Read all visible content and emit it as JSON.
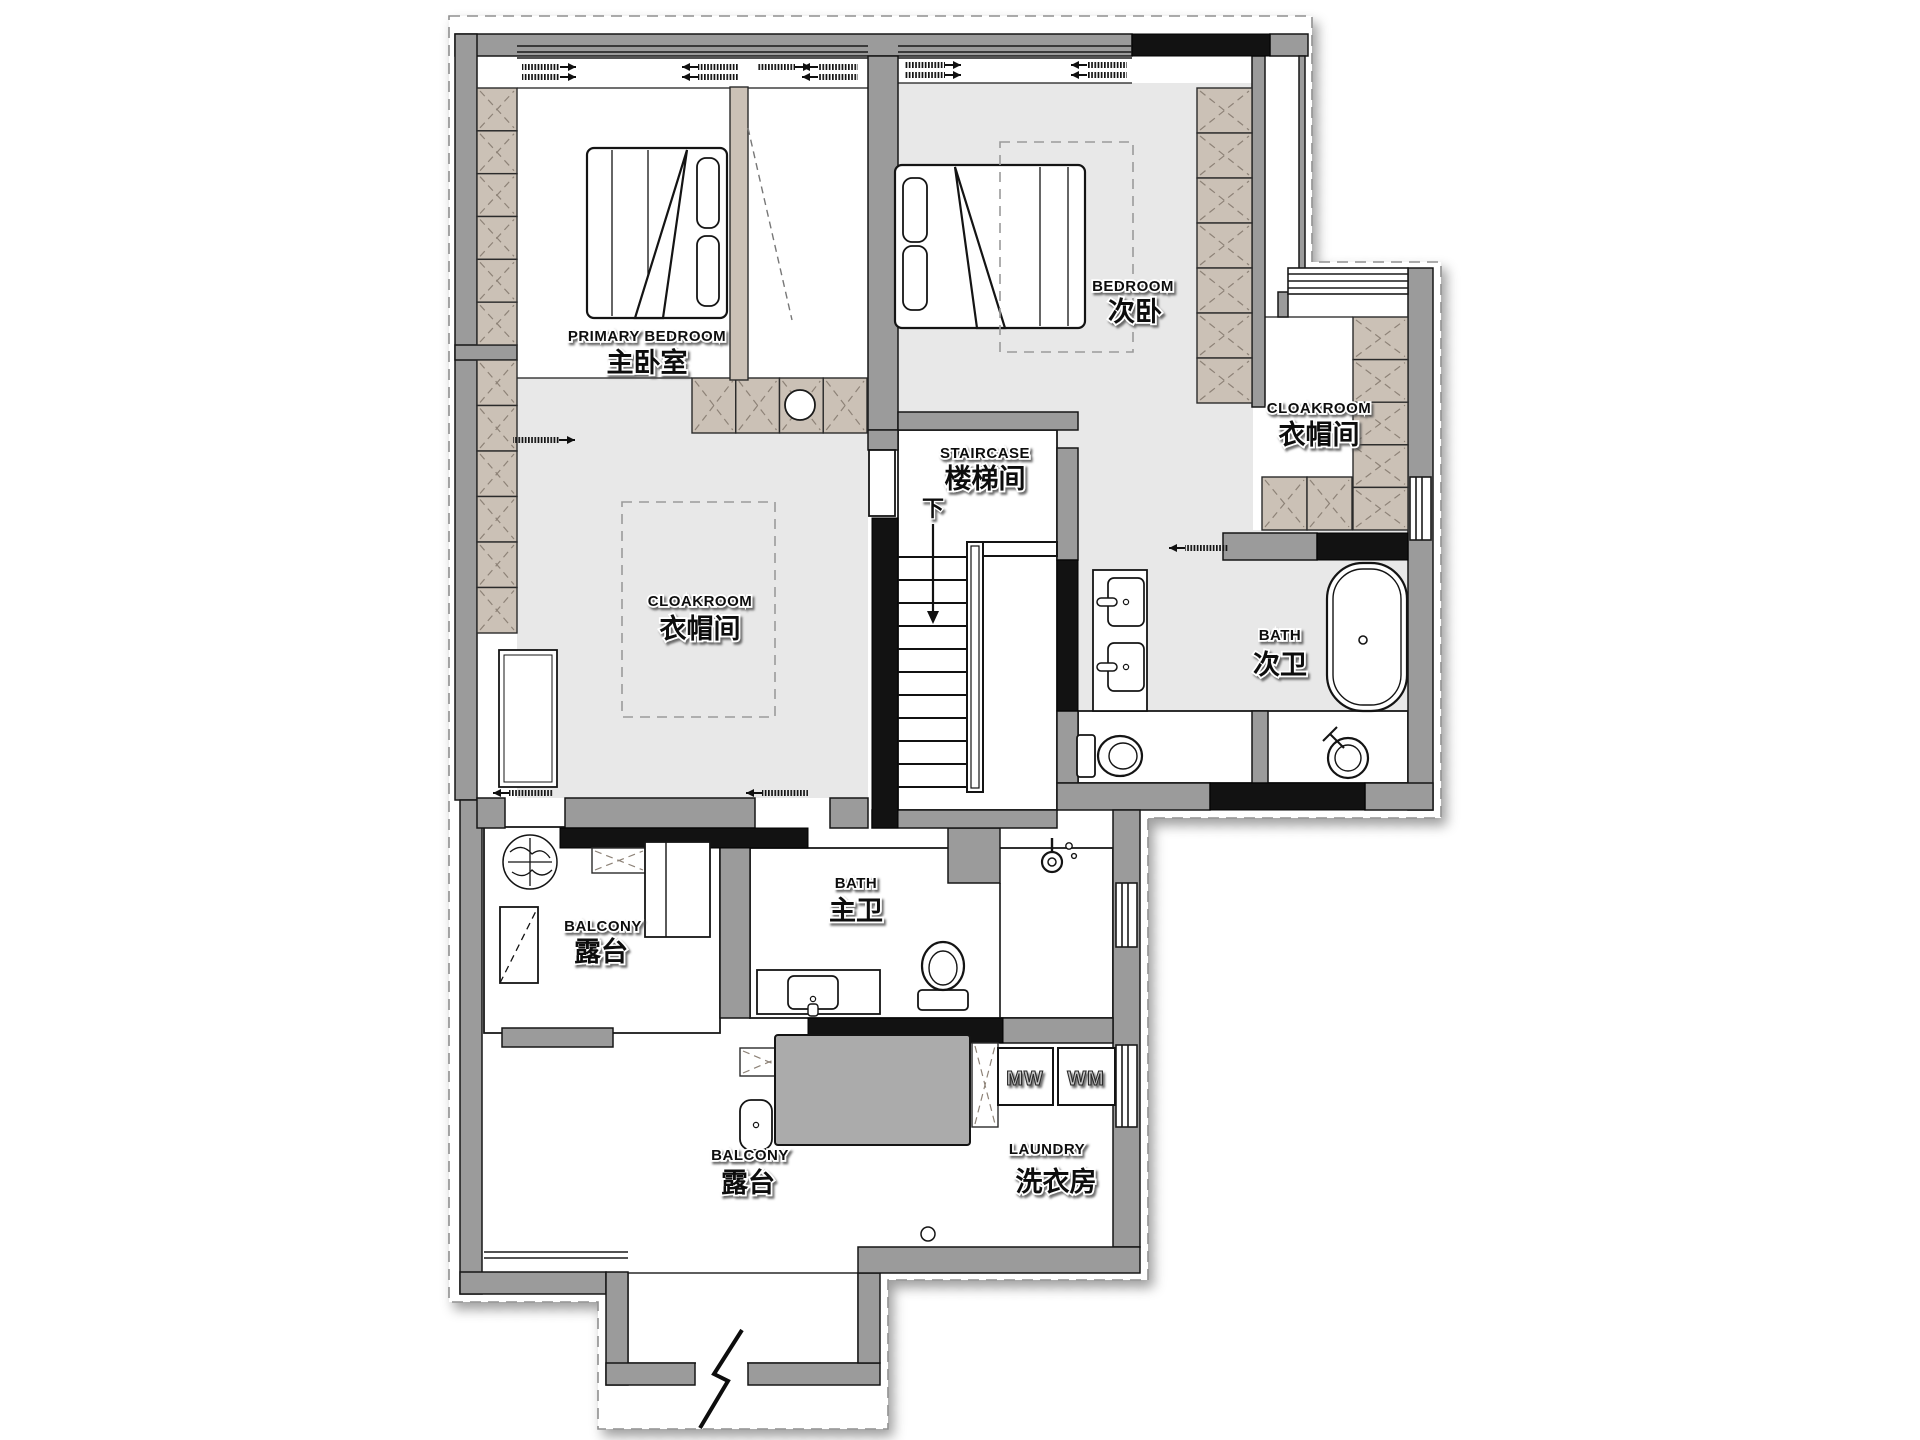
{
  "colors": {
    "wall_gray": "#9b9b9b",
    "wall_black": "#121212",
    "cabinet_tan": "#cbc1b6",
    "cabinet_hatch": "#8d8277",
    "floor_gray": "#e8e8e8",
    "line": "#1a1a1a",
    "table_gray": "#ababab"
  },
  "rooms": [
    {
      "id": "primary-bedroom",
      "en": "PRIMARY BEDROOM",
      "zh": "主卧室"
    },
    {
      "id": "bedroom",
      "en": "BEDROOM",
      "zh": "次卧"
    },
    {
      "id": "cloakroom-right",
      "en": "CLOAKROOM",
      "zh": "衣帽间"
    },
    {
      "id": "staircase",
      "en": "STAIRCASE",
      "zh": "楼梯间"
    },
    {
      "id": "cloakroom-center",
      "en": "CLOAKROOM",
      "zh": "衣帽间"
    },
    {
      "id": "bath-secondary",
      "en": "BATH",
      "zh": "次卫"
    },
    {
      "id": "bath-primary",
      "en": "BATH",
      "zh": "主卫"
    },
    {
      "id": "balcony-upper",
      "en": "BALCONY",
      "zh": "露台"
    },
    {
      "id": "balcony-lower",
      "en": "BALCONY",
      "zh": "露台"
    },
    {
      "id": "laundry",
      "en": "LAUNDRY",
      "zh": "洗衣房"
    }
  ],
  "appliances": {
    "microwave_label": "MW",
    "washer_label": "WM"
  },
  "stairs": {
    "down_label": "下"
  }
}
